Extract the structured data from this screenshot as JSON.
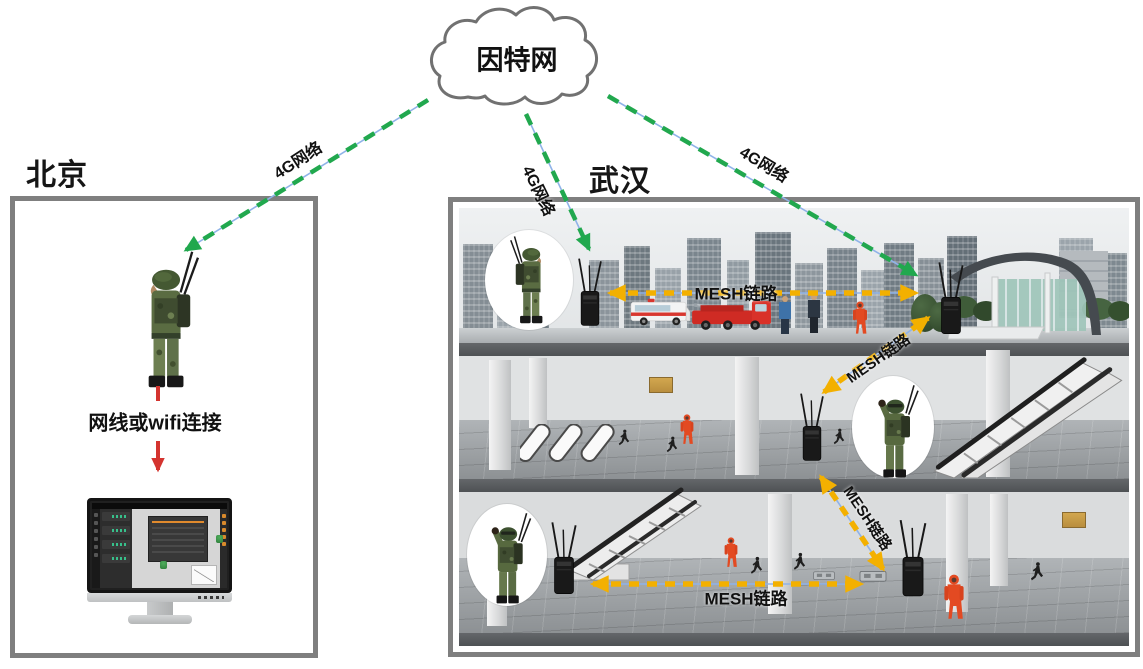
{
  "cloud": {
    "label": "因特网"
  },
  "regions": {
    "beijing": {
      "label": "北京"
    },
    "wuhan": {
      "label": "武汉"
    }
  },
  "links": {
    "g4_beijing": {
      "label": "4G网络"
    },
    "g4_wuhan_left": {
      "label": "4G网络"
    },
    "g4_wuhan_right": {
      "label": "4G网络"
    },
    "wired": {
      "label": "网线或wifi连接"
    },
    "mesh_ground": {
      "label": "MESH链路"
    },
    "mesh_ground_concourse": {
      "label": "MESH链路"
    },
    "mesh_concourse_platform": {
      "label": "MESH链路"
    },
    "mesh_platform": {
      "label": "MESH链路"
    }
  },
  "colors": {
    "g4_link": "#21a84e",
    "mesh_link": "#f3b000",
    "underlay": "#8fb3e8",
    "wired_link": "#d4342f",
    "border": "#7f7f7f",
    "label_text": "#111111"
  }
}
